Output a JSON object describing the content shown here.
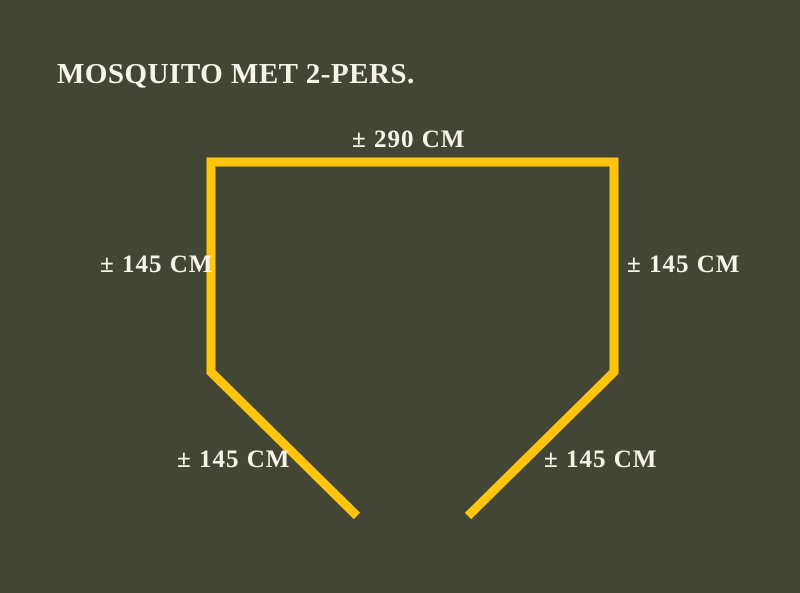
{
  "title": "MOSQUITO MET 2-PERS.",
  "labels": {
    "top": "± 290 CM",
    "left": "± 145 CM",
    "right": "± 145 CM",
    "bottom_left": "± 145 CM",
    "bottom_right": "± 145 CM"
  },
  "shape": {
    "kind": "tent-outline-open-bottom",
    "points": "357,516 211,372 211,162 614,162 614,372 468,516",
    "stroke_width": "9"
  },
  "colors": {
    "background": "#434635",
    "line": "#FFC40C",
    "text": "#F6F3EA"
  }
}
